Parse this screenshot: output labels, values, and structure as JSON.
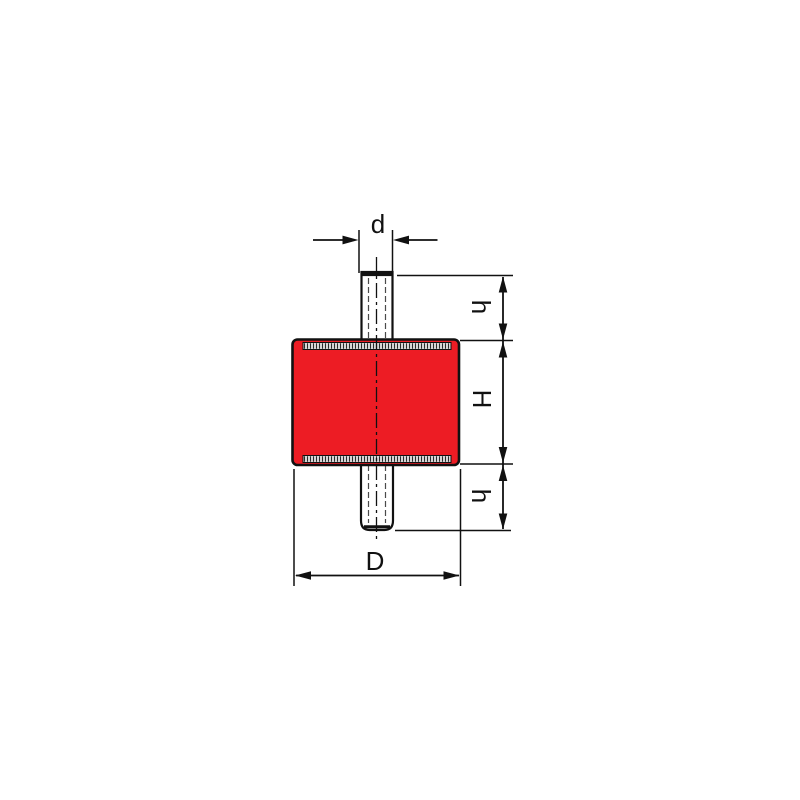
{
  "drawing": {
    "kind": "dimensioned-part-drawing",
    "labels": {
      "stud_diameter": "d",
      "stud_length_top": "h",
      "body_height": "H",
      "stud_length_bottom": "h",
      "body_diameter": "D"
    },
    "colors": {
      "body_fill": "#ed1c24",
      "line": "#111111",
      "knurl_fill": "#d6d6d6",
      "background": "#ffffff"
    }
  }
}
